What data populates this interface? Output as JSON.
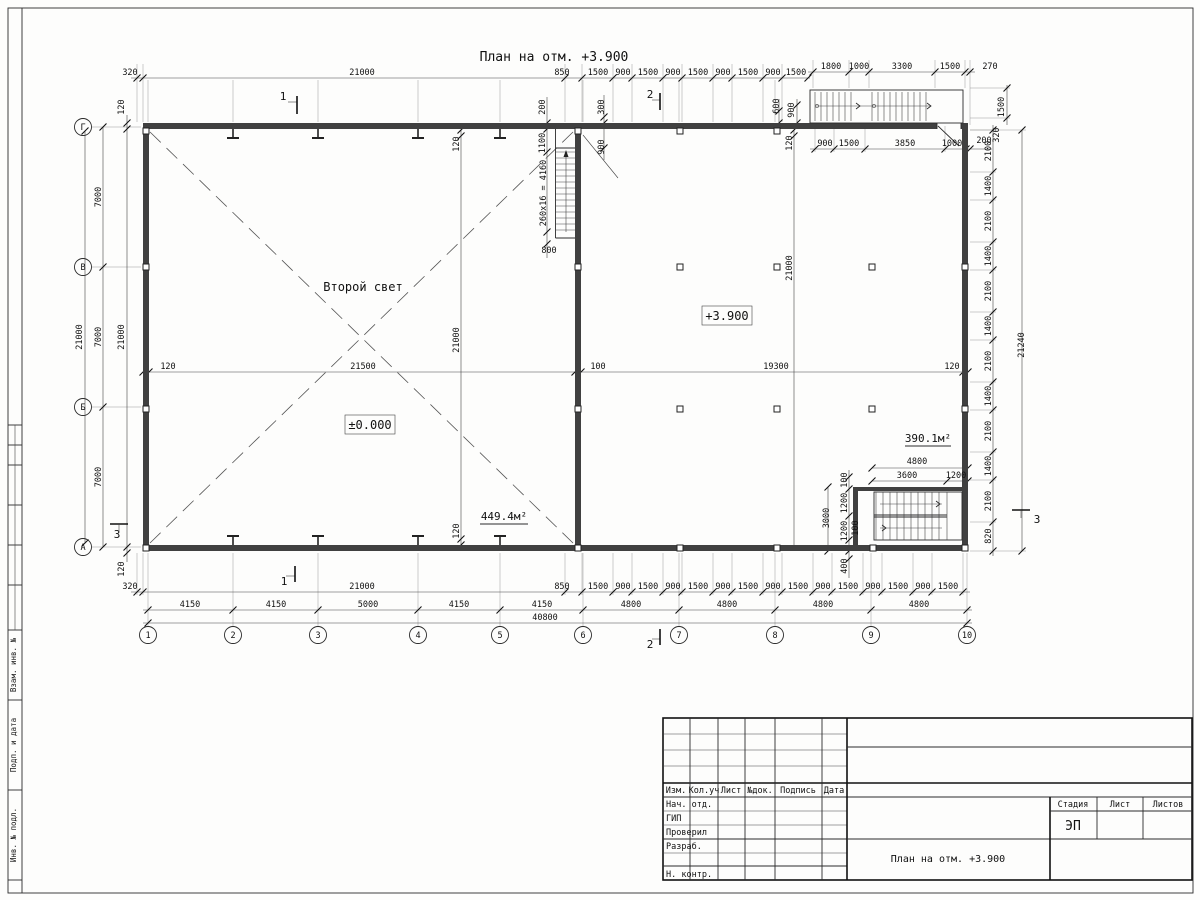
{
  "plan": {
    "title": "План на отм. +3.900",
    "labels": {
      "second_light": "Второй свет",
      "level_left": "±0.000",
      "level_right": "+3.900",
      "area_left": "449.4м²",
      "area_right": "390.1м²",
      "stair_note": "260x16 = 4160"
    },
    "axis_letters": [
      "Г",
      "В",
      "Б",
      "А"
    ],
    "axis_numbers": [
      "1",
      "2",
      "3",
      "4",
      "5",
      "6",
      "7",
      "8",
      "9",
      "10"
    ],
    "sections": {
      "s1": "1",
      "s2": "2",
      "s3": "3"
    },
    "dims": {
      "top": [
        "320",
        "21000",
        "850",
        "1500",
        "900",
        "1500",
        "900",
        "1500",
        "900",
        "1500",
        "900",
        "1500"
      ],
      "tru": [
        "1800",
        "1000",
        "3300",
        "1500",
        "270"
      ],
      "trl": [
        "900",
        "1500",
        "3850",
        "1000",
        "200"
      ],
      "trv": [
        "600",
        "900",
        "1500",
        "320"
      ],
      "stair": [
        "200",
        "300",
        "1100",
        "900",
        "800"
      ],
      "innerL": [
        "120",
        "21000",
        "120"
      ],
      "innerR": [
        "120",
        "21000"
      ],
      "left": [
        "7000",
        "7000",
        "7000",
        "21000",
        "21000",
        "120",
        "120"
      ],
      "mid": [
        "120",
        "21500",
        "100",
        "19300",
        "120"
      ],
      "right": [
        "2100",
        "1400",
        "2100",
        "1400",
        "2100",
        "1400",
        "2100",
        "1400",
        "2100",
        "1400",
        "2100",
        "820",
        "21240"
      ],
      "b1": [
        "320",
        "21000",
        "850",
        "1500",
        "900",
        "1500",
        "900",
        "1500",
        "900",
        "1500",
        "900",
        "1500",
        "900",
        "1500",
        "900",
        "1500",
        "900",
        "1500"
      ],
      "b2": [
        "4150",
        "4150",
        "5000",
        "4150",
        "4150",
        "4800",
        "4800",
        "4800",
        "4800"
      ],
      "btotal": "40800",
      "br": [
        "4800",
        "3600",
        "1200",
        "3000",
        "100",
        "1200",
        "1200",
        "100",
        "400"
      ]
    }
  },
  "frame": {
    "stamp_left": [
      "Взам. инв. №",
      "Подп. и дата",
      "Инв. № подл."
    ],
    "titleblock": {
      "header": [
        "Изм.",
        "Кол.уч",
        "Лист",
        "№док.",
        "Подпись",
        "Дата"
      ],
      "rows": [
        "Нач. отд.",
        "ГИП",
        "Проверил",
        "Разраб.",
        "Н. контр."
      ],
      "stage_label": "Стадия",
      "sheet_label": "Лист",
      "sheets_label": "Листов",
      "stage_value": "ЭП",
      "doc_title": "План на отм. +3.900"
    }
  }
}
